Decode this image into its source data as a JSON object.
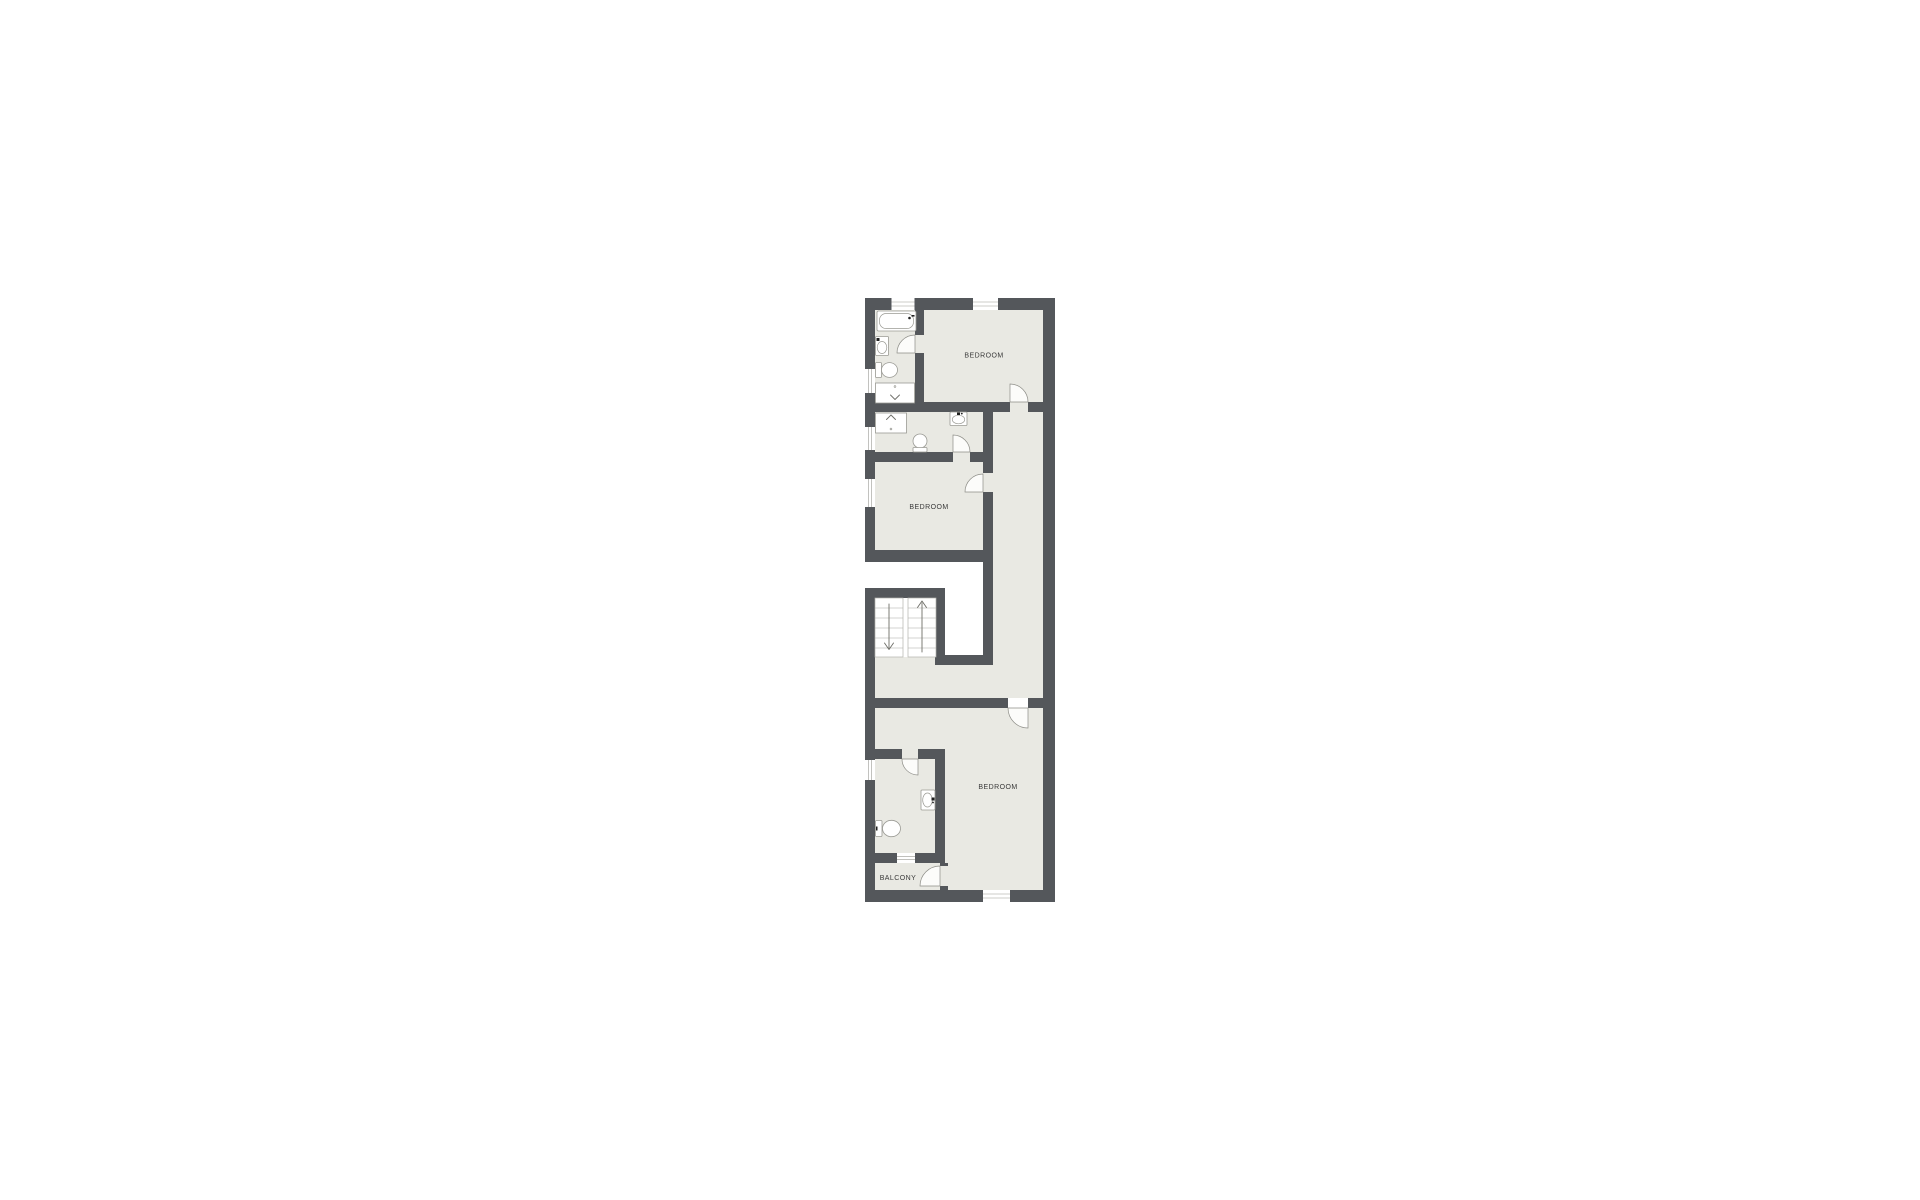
{
  "window": {
    "width": 1920,
    "height": 1200,
    "background": "#ffffff"
  },
  "floorplan": {
    "type": "residential-floor-plan",
    "orientation": "vertical-narrow-unit",
    "labels": [
      {
        "id": "bedroom-top",
        "text": "BEDROOM"
      },
      {
        "id": "bedroom-middle",
        "text": "BEDROOM"
      },
      {
        "id": "bedroom-bottom",
        "text": "BEDROOM"
      },
      {
        "id": "balcony",
        "text": "BALCONY"
      }
    ],
    "colors": {
      "wall": "#54575b",
      "floor": "#e9e9e3",
      "fixture": "#9a9a94",
      "door": "#8d8d87",
      "stair": "#a8a8a2",
      "text": "#3a3a3a",
      "bg": "#ffffff"
    },
    "icons": [
      "bathtub-icon",
      "sink-icon",
      "toilet-icon",
      "shower-icon",
      "stairs-icon",
      "stairs-up-arrow-icon",
      "stairs-down-arrow-icon",
      "door-swing-icon",
      "window-icon"
    ]
  }
}
